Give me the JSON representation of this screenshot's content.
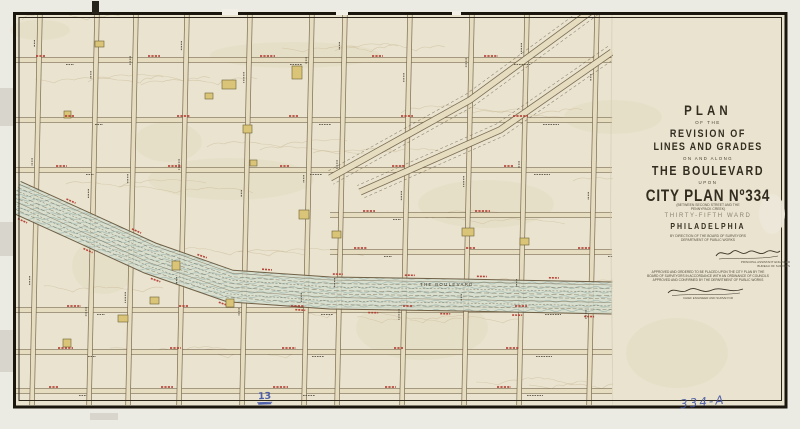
{
  "title_block": {
    "plan": "PLAN",
    "of_the": "OF THE",
    "revision": "REVISION OF",
    "lines_grades": "LINES AND GRADES",
    "on_along": "ON AND ALONG",
    "boulevard": "THE BOULEVARD",
    "upon": "UPON",
    "city_plan": "CITY PLAN Nº334",
    "paren1": "(BETWEEN SECOND STREET AND THE",
    "paren2": "PENNYPACK CREEK)",
    "ward": "THIRTY-FIFTH WARD",
    "city": "PHILADELPHIA",
    "dept1": "BY DIRECTION OF THE BOARD OF SURVEYORS",
    "dept2": "DEPARTMENT OF PUBLIC WORKS",
    "sig1_caption1": "PRINCIPAL ASSISTANT ENGINEER",
    "sig1_caption2": "BUREAU OF SURVEYS",
    "approval1": "APPROVED AND ORDERED TO BE PLACED UPON THE CITY PLAN BY THE",
    "approval2": "BOARD OF SURVEYORS IN ACCORDANCE WITH AN ORDINANCE OF COUNCILS",
    "approval3": "APPROVED AND CONFIRMED BY THE DEPARTMENT OF PUBLIC WORKS",
    "sig2_caption": "CHIEF ENGINEER AND SURVEYOR"
  },
  "annotations": {
    "page_number": "13",
    "plan_number": "334-A"
  },
  "map": {
    "colors": {
      "paper": "#e9e3cf",
      "margin": "#ecebe3",
      "frame": "#1b160d",
      "street_casing": "#6f5f45",
      "street_fill": "#e6dcc0",
      "boulevard_wash": "#d6decf",
      "boulevard_wave": "#9eb5ae",
      "contour": "#c4ad85",
      "building_fill": "#d9c477",
      "building_stroke": "#6e6335",
      "red_ink": "#b2372b",
      "dark_ink": "#3a3327",
      "pencil_blue": "#3e50a3"
    },
    "vertical_streets": [
      40,
      97,
      136,
      187,
      250,
      312,
      345,
      410,
      472,
      527,
      597
    ],
    "horizontal_streets": [
      {
        "y": 60
      },
      {
        "y": 120
      },
      {
        "y": 170
      },
      {
        "y": 215,
        "x1": 330
      },
      {
        "y": 252,
        "x1": 330
      },
      {
        "y": 310
      },
      {
        "y": 352
      },
      {
        "y": 391
      }
    ],
    "boulevard": {
      "points": [
        [
          14,
          196
        ],
        [
          80,
          226
        ],
        [
          150,
          258
        ],
        [
          230,
          286
        ],
        [
          330,
          293
        ],
        [
          460,
          295
        ],
        [
          612,
          298
        ]
      ],
      "half_width": 16,
      "label": "THE BOULEVARD",
      "label_x": 420,
      "label_y": 286
    },
    "diagonals": [
      {
        "points": [
          [
            598,
            6
          ],
          [
            470,
            100
          ],
          [
            330,
            178
          ]
        ]
      },
      {
        "points": [
          [
            612,
            52
          ],
          [
            500,
            130
          ],
          [
            360,
            192
          ]
        ]
      }
    ],
    "buildings": [
      [
        222,
        80,
        14,
        9
      ],
      [
        292,
        66,
        10,
        13
      ],
      [
        243,
        125,
        9,
        8
      ],
      [
        205,
        93,
        8,
        6
      ],
      [
        299,
        210,
        10,
        9
      ],
      [
        172,
        261,
        8,
        9
      ],
      [
        150,
        297,
        9,
        7
      ],
      [
        226,
        299,
        8,
        8
      ],
      [
        118,
        315,
        10,
        7
      ],
      [
        63,
        339,
        8,
        8
      ],
      [
        95,
        41,
        9,
        6
      ],
      [
        64,
        111,
        7,
        7
      ],
      [
        520,
        238,
        9,
        7
      ],
      [
        462,
        228,
        12,
        8
      ],
      [
        332,
        231,
        9,
        7
      ],
      [
        250,
        160,
        7,
        6
      ]
    ],
    "margin_smudges": [
      [
        0,
        88,
        13,
        38
      ],
      [
        0,
        222,
        13,
        34
      ],
      [
        0,
        330,
        14,
        42
      ],
      [
        90,
        413,
        28,
        7
      ]
    ]
  }
}
